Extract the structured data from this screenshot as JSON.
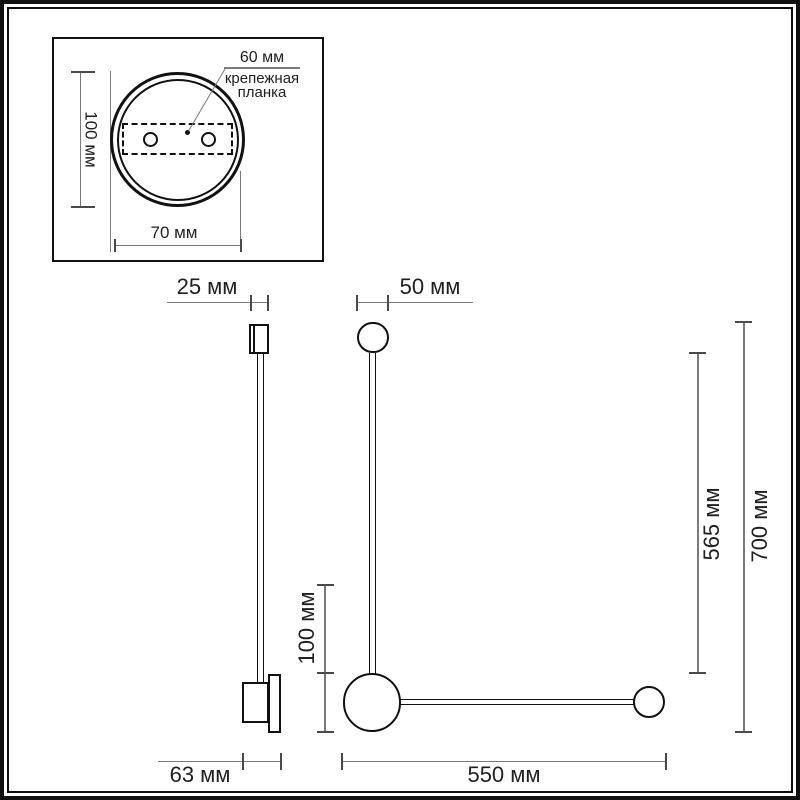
{
  "colors": {
    "ink": "#111111",
    "dim_line": "#7a7a7a",
    "tick": "#4a4a4a",
    "text": "#1f1f1f",
    "frame": "#101010",
    "background": "#ffffff"
  },
  "inset": {
    "bracket_width_label": "60 мм",
    "bracket_name_line1": "крепежная",
    "bracket_name_line2": "планка",
    "plate_height_label": "100 мм",
    "bracket_span_label": "70 мм"
  },
  "side_view": {
    "head_depth_label": "25 мм",
    "mount_depth_label": "63 мм"
  },
  "front_view": {
    "head_diameter_label": "50 мм",
    "base_diameter_label": "100 мм",
    "rod_span_label": "565 мм",
    "total_height_label": "700 мм",
    "arm_length_label": "550 мм"
  }
}
